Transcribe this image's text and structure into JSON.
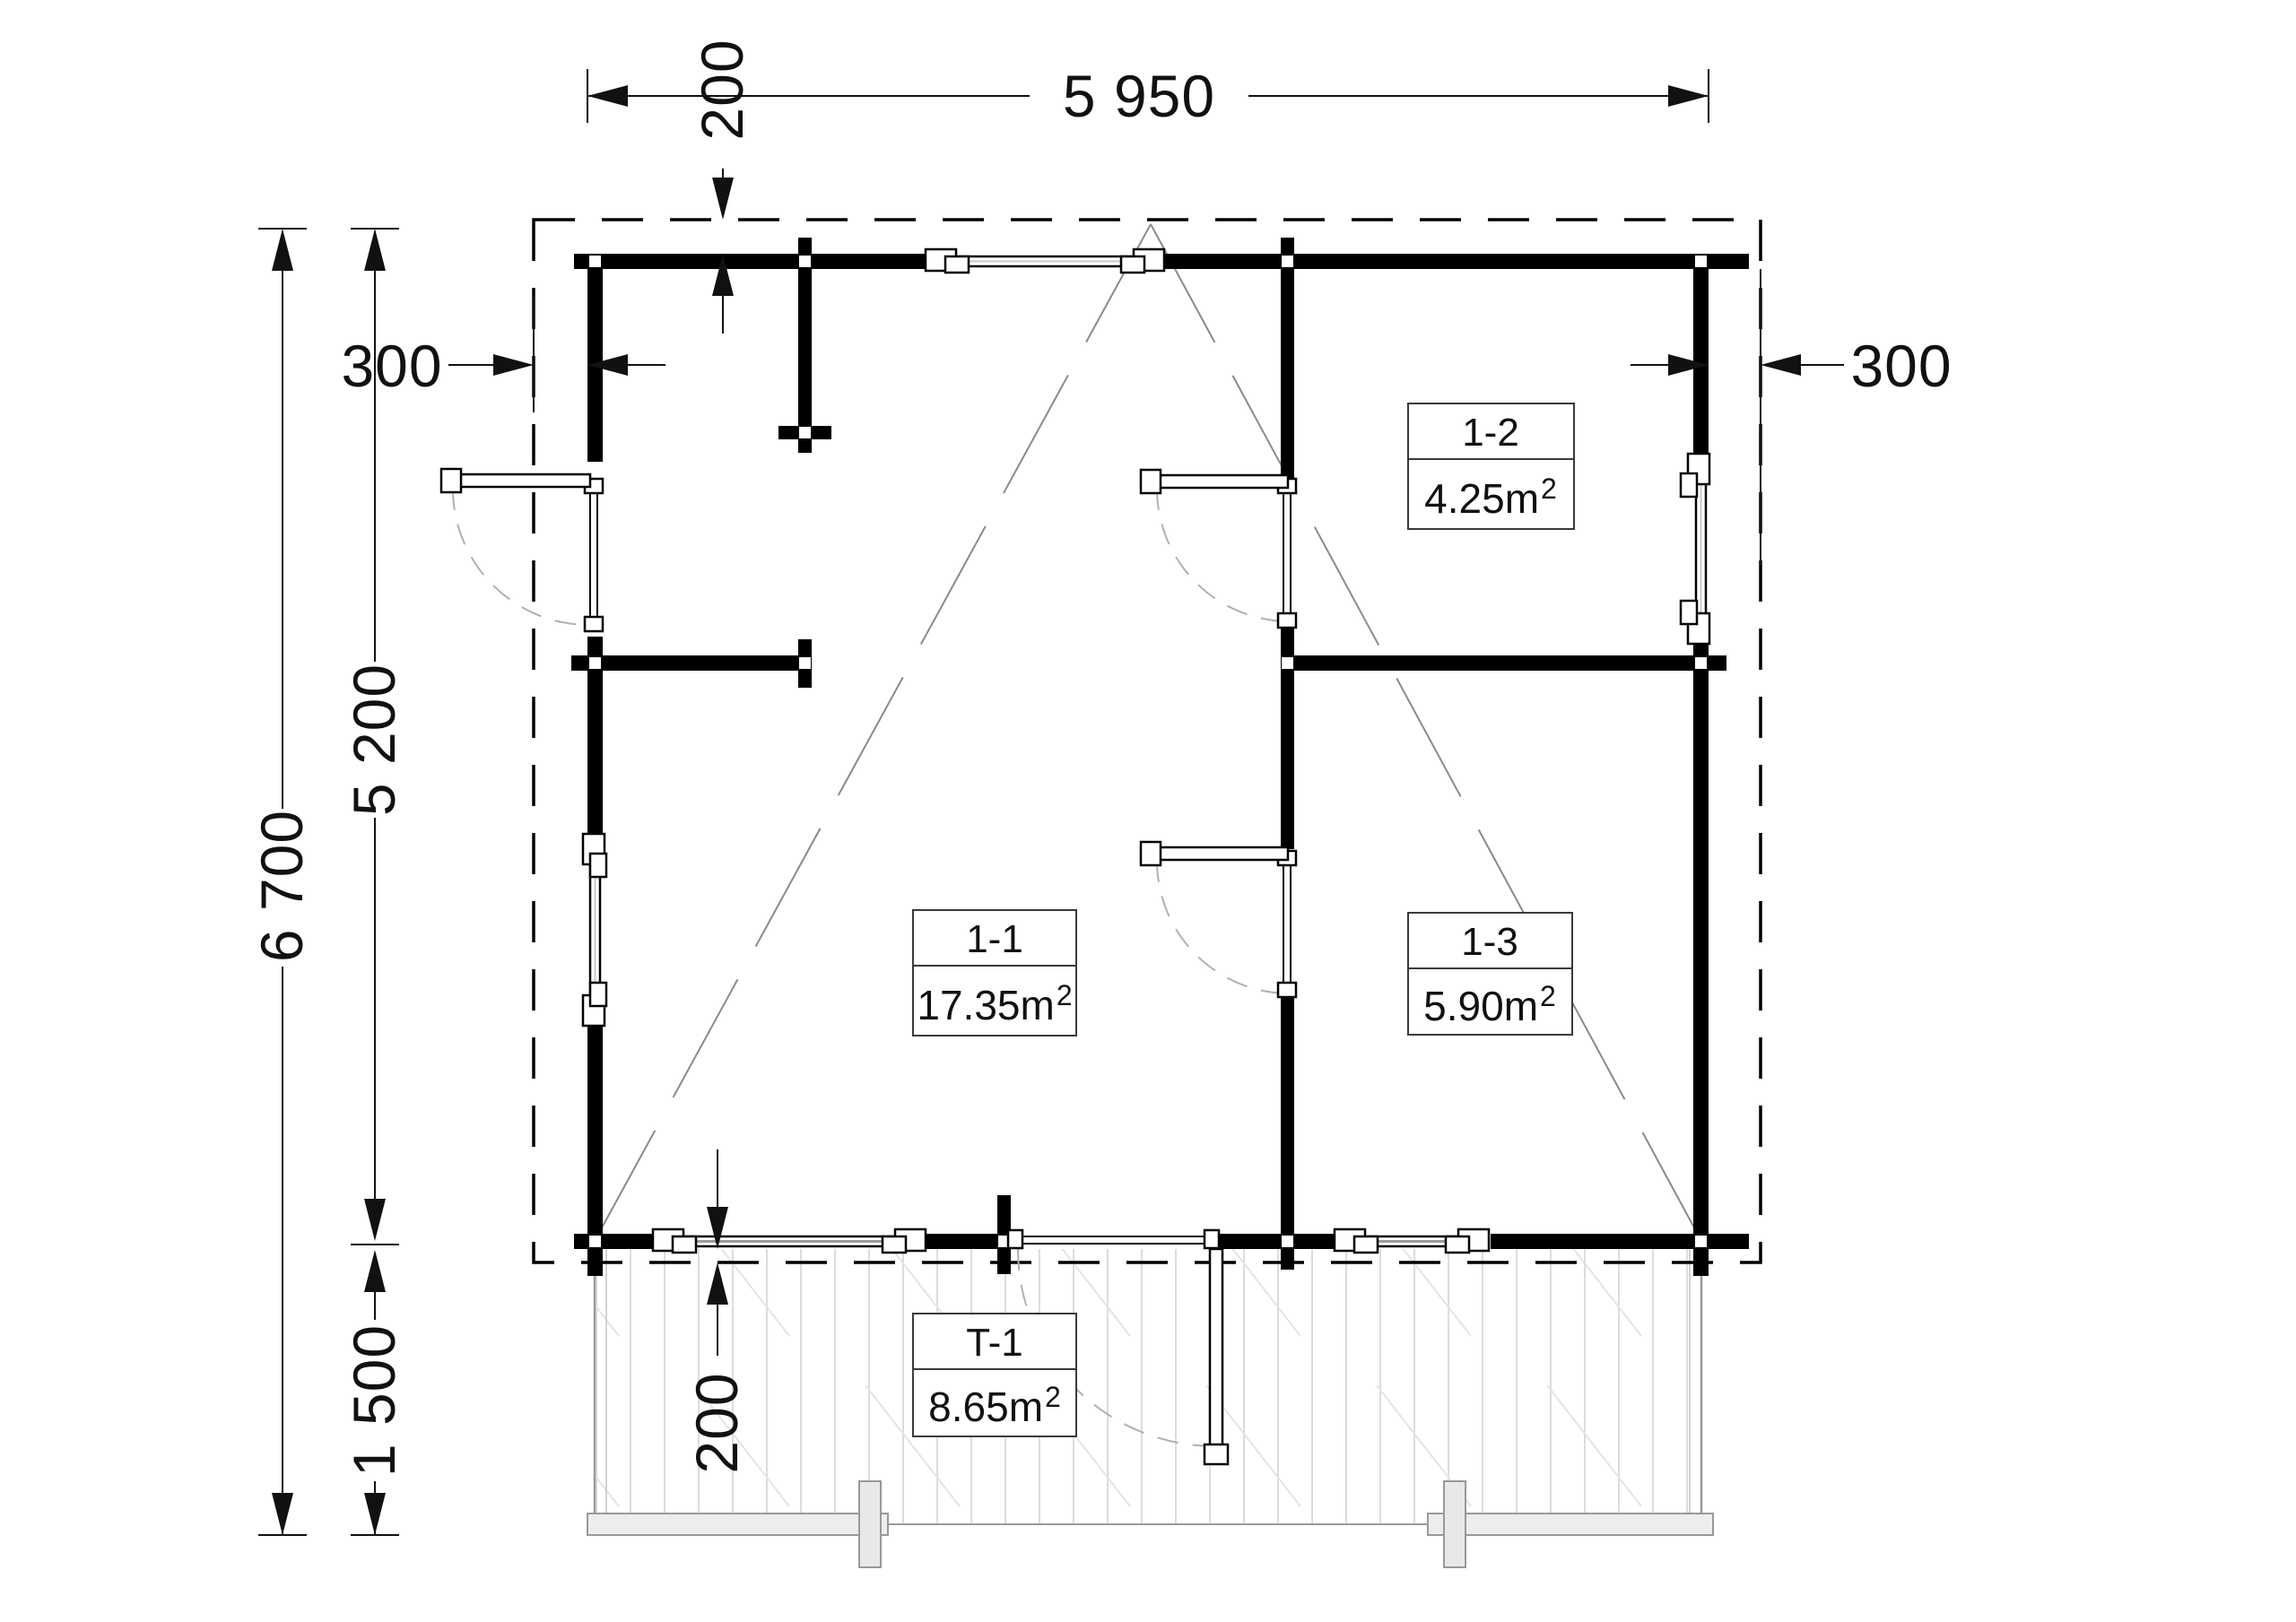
{
  "plan": {
    "type": "floor-plan",
    "dimensions": {
      "top_width": "5 950",
      "top_overhang": "200",
      "left_offset": "300",
      "right_offset": "300",
      "total_depth": "6 700",
      "house_depth": "5 200",
      "terrace_depth": "1 500",
      "bottom_overhang": "200"
    },
    "rooms": [
      {
        "id": "1-1",
        "area": "17.35m",
        "area_sup": "2"
      },
      {
        "id": "1-2",
        "area": "4.25m",
        "area_sup": "2"
      },
      {
        "id": "1-3",
        "area": "5.90m",
        "area_sup": "2"
      },
      {
        "id": "T-1",
        "area": "8.65m",
        "area_sup": "2"
      }
    ],
    "colors": {
      "wall": "#000000",
      "dimension": "#111111",
      "roof_line": "#8a8a8a",
      "door_arc": "#b0b0b0",
      "deck_line": "#dcdcdc",
      "terrace_border": "#9a9a9a",
      "beam_fill": "#ededed"
    }
  }
}
